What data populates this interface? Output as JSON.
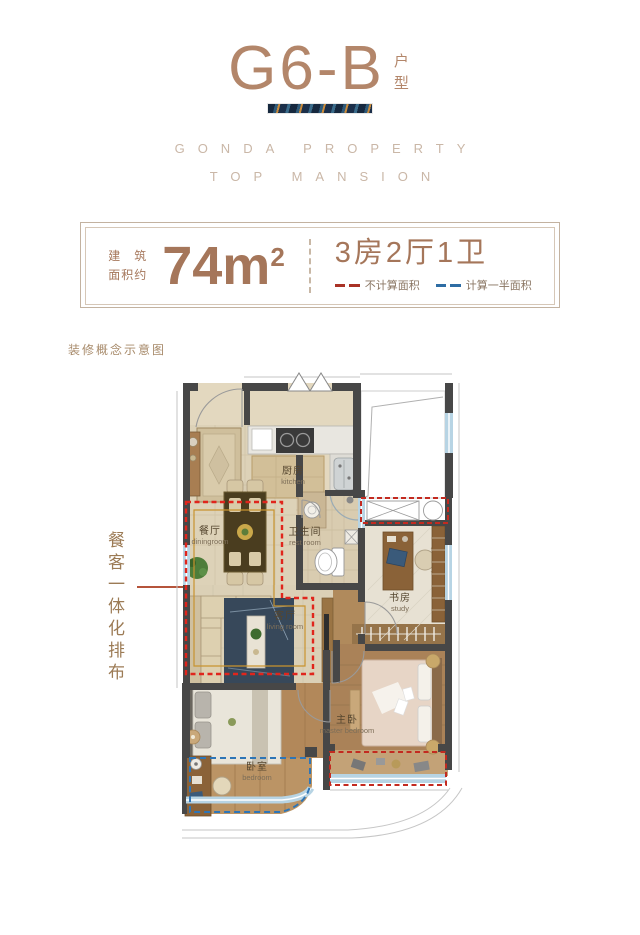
{
  "header": {
    "title": "G6-B",
    "title_suffix": "户型",
    "brand_line1": "GONDA PROPERTY",
    "brand_line2": "TOP MANSION"
  },
  "info_box": {
    "area_label_line1": "建　筑",
    "area_label_line2": "面积约",
    "area_value": "74m",
    "area_sup": "2",
    "layout_text": "3房2厅1卫",
    "legend": [
      {
        "label": "不计算面积",
        "color": "#a93226"
      },
      {
        "label": "计算一半面积",
        "color": "#2e6da4"
      }
    ]
  },
  "note": "装修概念示意图",
  "annotation": {
    "text": "餐客一体化排布"
  },
  "floorplan": {
    "rooms": {
      "kitchen": {
        "cn": "厨房",
        "en": "kitchen"
      },
      "dining": {
        "cn": "餐厅",
        "en": "diningroom"
      },
      "bath": {
        "cn": "卫生间",
        "en": "rest room"
      },
      "study": {
        "cn": "书房",
        "en": "study"
      },
      "living": {
        "cn": "客厅",
        "en": "living room"
      },
      "master": {
        "cn": "主卧",
        "en": "master bedroom"
      },
      "bedroom": {
        "cn": "卧室",
        "en": "bedroom"
      }
    }
  },
  "colors": {
    "accent_brown": "#a5765a",
    "title_brown": "#b3866a",
    "red_dash": "#d2281e",
    "blue_dash": "#2e75b6",
    "orange_line": "#c8932f",
    "wall": "#474747",
    "window": "#b7d4e4"
  }
}
